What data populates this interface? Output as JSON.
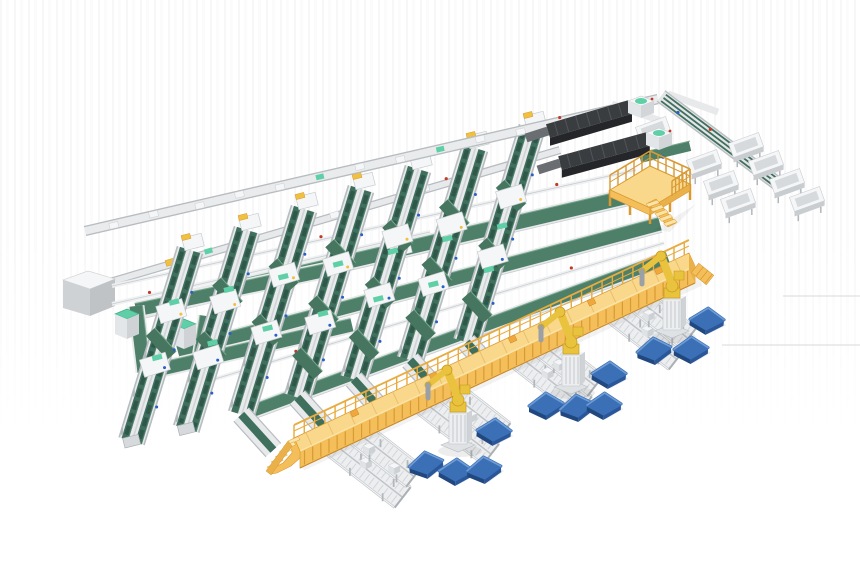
{
  "meta": {
    "title": "Automated parcel sorting and robotic palletizing facility — isometric 3D render",
    "canvas": {
      "width": 860,
      "height": 580
    }
  },
  "palette": {
    "background": "#ffffff",
    "belt_green": "#3f6f5d",
    "belt_green_dark": "#2f574a",
    "belt_green_light": "#5d8b75",
    "cross_green": "#4e8069",
    "cross_green_edge": "#79a88f",
    "mint": "#5ecfa6",
    "frame_white": "#f5f6f7",
    "frame_light": "#e7e9eb",
    "frame_mid": "#c9cdd0",
    "frame_dark": "#aab0b4",
    "rail_grey": "#b6bcc0",
    "roller_bed": "#eceef0",
    "roller_tick": "#d3d6d9",
    "yellow_deck": "#f9d88c",
    "yellow_wall": "#f4bf5a",
    "yellow_light": "#fce4a8",
    "yellow_dark": "#d9992f",
    "yellow_rib": "#d89a33",
    "orange_box": "#f0a83c",
    "robot_yellow": "#e9c33d",
    "robot_dark": "#c79b24",
    "steel": "#9aa0a5",
    "dark_top": "#3a3d40",
    "dark_side": "#242629",
    "dark_rib": "#515559",
    "pallet_top": "#3b70b6",
    "pallet_light": "#6f9cd6",
    "pallet_side": "#2a569a",
    "pallet_dark": "#21477f",
    "accent_red": "#c2392a",
    "accent_blue": "#2a5fc4",
    "artifact_grey": "#d9d9d9",
    "shadow": "#000000"
  },
  "inventory": {
    "components": [
      {
        "id": "infeed-conveyor-line",
        "label": "Top infeed conveyor line with totes",
        "count": 1
      },
      {
        "id": "transfer-line",
        "label": "Upper transfer conveyor line",
        "count": 1
      },
      {
        "id": "telescopic-loader",
        "label": "Telescopic truck-loading conveyor",
        "count": 2
      },
      {
        "id": "induction-station",
        "label": "Induction station at sorter line head",
        "count": 7
      },
      {
        "id": "sorter-line",
        "label": "Steep twin-belt sorting line",
        "count": 7
      },
      {
        "id": "cross-belt",
        "label": "Green cross conveyor belt",
        "count": 3
      },
      {
        "id": "service-rail",
        "label": "White service rail with sensors",
        "count": 3
      },
      {
        "id": "recirculation-loop",
        "label": "Green recirculation conveyor loop",
        "count": 1
      },
      {
        "id": "electrical-cabinet",
        "label": "Grey electrical cabinet",
        "count": 1
      },
      {
        "id": "control-cabinet",
        "label": "Control cabinet with mint top",
        "count": 2
      },
      {
        "id": "operator-platform",
        "label": "Yellow operator platform with stairs",
        "count": 1
      },
      {
        "id": "sorter-extension",
        "label": "Multi-lane sorter extension loop",
        "count": 1
      },
      {
        "id": "chute-bin",
        "label": "White chute bin",
        "count": 8
      },
      {
        "id": "elevated-walkway",
        "label": "Yellow elevated walkway with railing and stairs",
        "count": 1
      },
      {
        "id": "discharge-lane",
        "label": "Roller discharge lane",
        "count": 8
      },
      {
        "id": "palletizing-robot",
        "label": "Yellow palletizing robot arm",
        "count": 3
      },
      {
        "id": "pallet",
        "label": "Blue pallet",
        "count": 11
      },
      {
        "id": "render-artifact-line",
        "label": "Faint render artifact line",
        "count": 2
      }
    ]
  }
}
